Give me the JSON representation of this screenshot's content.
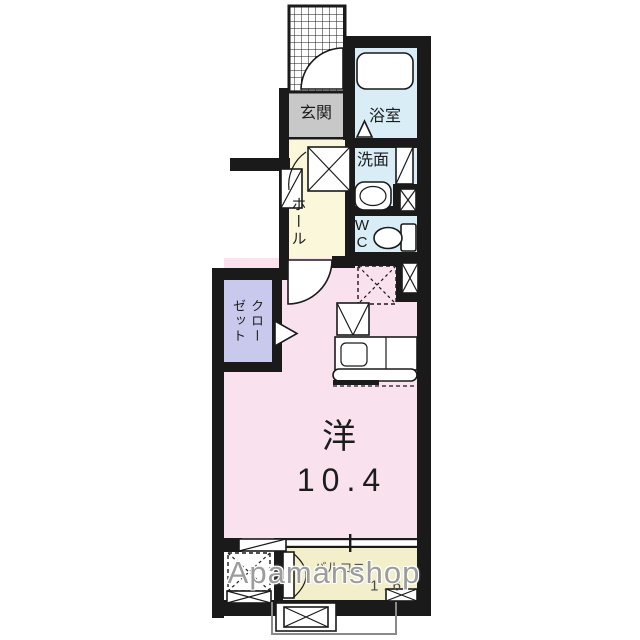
{
  "colors": {
    "wall": "#1a1a1a",
    "room-pink": "#f9e2ee",
    "hall-yellow": "#fbf7da",
    "balcony-yellow": "#f2efca",
    "water-blue": "#d8edf6",
    "closet-purple": "#c9c9ee",
    "entrance-gray": "#c8c8c8",
    "watermark-gray": "#9c9c9c",
    "label-dark": "#1c1c1c",
    "balcony-text": "#4a4a4a"
  },
  "rooms": {
    "entrance": {
      "label": "玄関"
    },
    "bathroom": {
      "label": "浴室"
    },
    "washroom": {
      "label": "洗面"
    },
    "toilet": {
      "label": "W\nC"
    },
    "hall": {
      "label": "ホール"
    },
    "closet": {
      "label": "クローゼット"
    },
    "main_room": {
      "label": "洋",
      "size": "10.4"
    },
    "balcony": {
      "label": "バルコニー",
      "size": "1.6"
    }
  },
  "watermark": {
    "text": "Apamanshop"
  }
}
